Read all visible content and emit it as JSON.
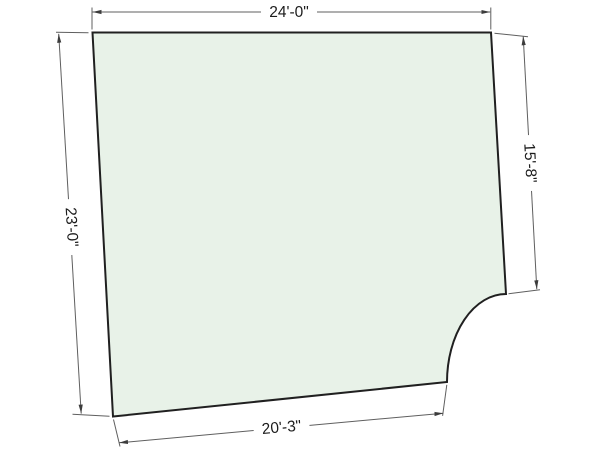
{
  "floor_plan": {
    "description": "Room outline floor plan with concave quarter-round notch at bottom-right corner and four linear dimensions",
    "dimensions": {
      "top": "24'-0\"",
      "left": "23'-0\"",
      "right": "15'-8\"",
      "bottom": "20'-3\""
    },
    "colors": {
      "background": "#ffffff",
      "room_fill": "#e8f2e8",
      "room_outline": "#202020",
      "dimension_lines": "#5f5f5f",
      "arrowheads": "#3c3c3c",
      "text": "#1c1c1c"
    }
  }
}
